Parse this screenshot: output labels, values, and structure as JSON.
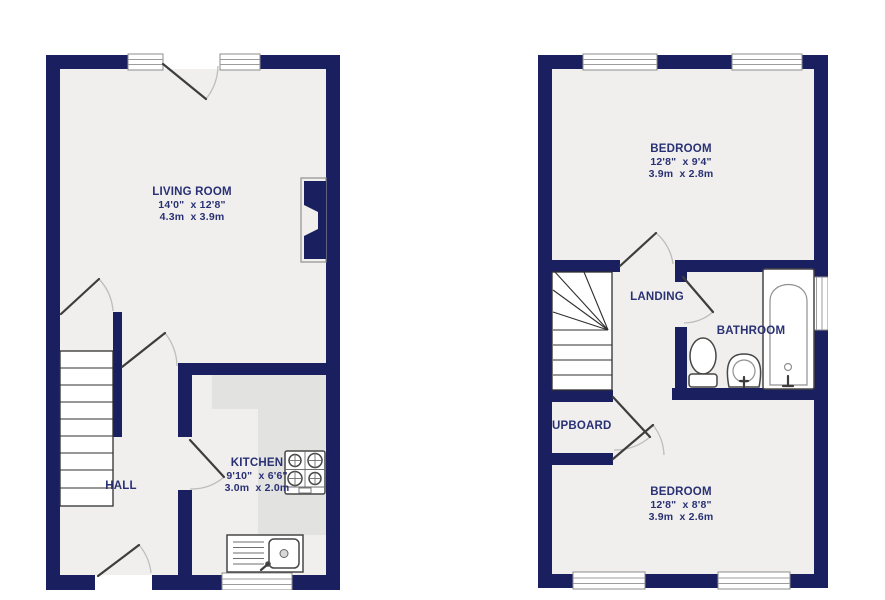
{
  "theme": {
    "wall_color": "#1a1f60",
    "label_color": "#293174",
    "floor_color": "#f0efed",
    "counter_color": "#e2e2e1",
    "leaf_color": "#3d3d3d",
    "arc_color": "#bdbdbd"
  },
  "ground_floor": {
    "living_room": {
      "name": "LIVING ROOM",
      "size_imperial": "14'0\"  x 12'8\"",
      "size_metric": "4.3m  x 3.9m"
    },
    "kitchen": {
      "name": "KITCHEN",
      "size_imperial": "9'10\"  x 6'6\"",
      "size_metric": "3.0m  x 2.0m"
    },
    "hall": {
      "name": "HALL"
    }
  },
  "first_floor": {
    "bedroom_front": {
      "name": "BEDROOM",
      "size_imperial": "12'8\"  x 9'4\"",
      "size_metric": "3.9m  x 2.8m"
    },
    "landing": {
      "name": "LANDING"
    },
    "bathroom": {
      "name": "BATHROOM"
    },
    "cupboard": {
      "name": "UPBOARD"
    },
    "bedroom_back": {
      "name": "BEDROOM",
      "size_imperial": "12'8\"  x 8'8\"",
      "size_metric": "3.9m  x 2.6m"
    }
  }
}
